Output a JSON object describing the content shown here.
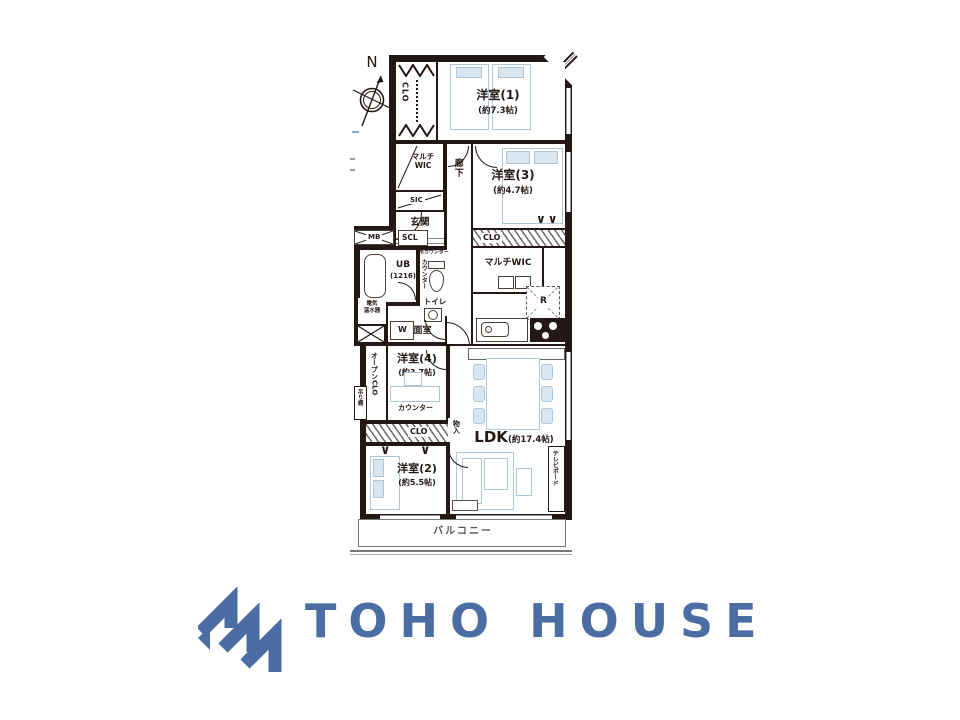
{
  "palette": {
    "wall": "#231815",
    "furniture_line": "#aec6da",
    "logo_blue": "#4a6da4",
    "balcony_text": "#555555"
  },
  "compass": {
    "north": "N"
  },
  "rooms": {
    "r1": {
      "name": "洋室(1)",
      "size": "(約7.3帖)"
    },
    "r3": {
      "name": "洋室(3)",
      "size": "(約4.7帖)"
    },
    "r4": {
      "name": "洋室(4)",
      "size": "(約3.7帖)"
    },
    "r2": {
      "name": "洋室(2)",
      "size": "(約5.5帖)"
    },
    "ldk": {
      "name": "LDK",
      "size": "(約17.4帖)"
    },
    "genkan": "玄関",
    "rouka": "廊下",
    "toilet": "トイレ",
    "senmen": "洗面室",
    "ub": {
      "name": "UB",
      "size": "(1216)"
    },
    "balcony": "バルコニー"
  },
  "labels": {
    "clo_r1": "CLO",
    "multi_wic_l1": "マルチ",
    "multi_wic_l2": "WIC",
    "sic": "SIC",
    "scl": "SCL",
    "mb": "MB",
    "denki1": "電気",
    "denki2": "温水器",
    "washer": "W",
    "hanging_counter": "吊カウンター",
    "counter_v": "カウンター",
    "clo_r3": "CLO",
    "multi_wic_right": "マルチWIC",
    "fridge": "R",
    "open_clo": "オープンCLO",
    "tsuridana": "吊り棚",
    "counter_r4": "カウンター",
    "clo_r4": "CLO",
    "monoire": "物入",
    "tv_board": "テレビボード"
  },
  "logo": {
    "text": "TOHO HOUSE"
  }
}
